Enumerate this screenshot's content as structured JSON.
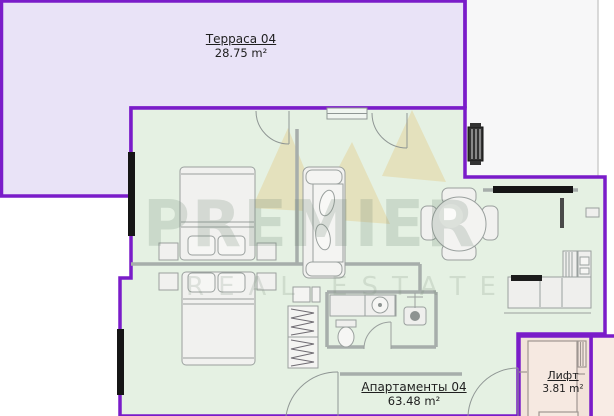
{
  "rooms": {
    "terrace": {
      "name": "Терраса 04",
      "area": "28.75 m²"
    },
    "apartment": {
      "name": "Апартаменты 04",
      "area": "63.48 m²"
    },
    "elevator": {
      "name": "Лифт",
      "area": "3.81 m²"
    }
  },
  "watermark": {
    "line1": "PREMIER",
    "line2": "REAL ESTATE"
  },
  "colors": {
    "outer_wall": "#7a1cc9",
    "terrace_fill": "#e9e3f7",
    "apartment_fill": "#e5f1e3",
    "elevator_fill": "#f2e3da",
    "adjacent_fill": "#f8ece5",
    "outside_fill": "#f7f7f8",
    "window": "#151515",
    "label_text": "#1f1f1f"
  }
}
